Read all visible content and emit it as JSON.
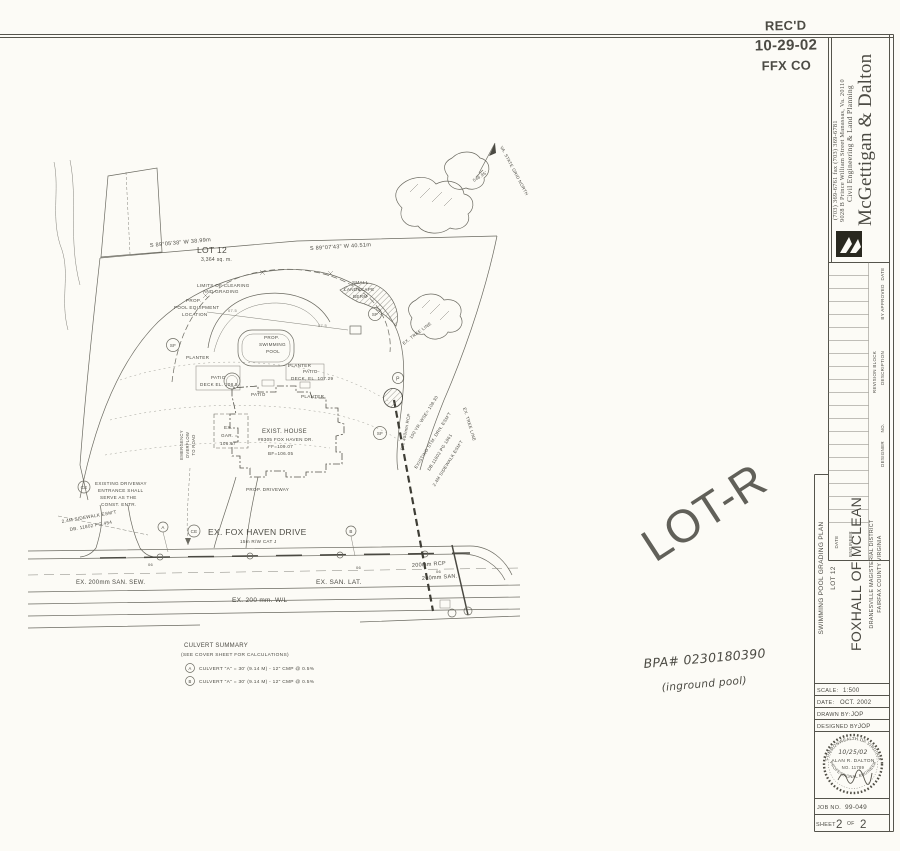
{
  "received_stamp": {
    "line1": "REC'D",
    "line2": "10-29-02",
    "line3": "FFX CO"
  },
  "firm": {
    "name": "McGettigan & Dalton",
    "tagline": "Civil Engineering & Land Planning",
    "address": "9028 B Prince William Street Manassas, Va. 20110",
    "phones": "(703) 369-6761        fax (703) 369-6781"
  },
  "revision_block": {
    "title": "REVISION BLOCK",
    "col_date": "DATE",
    "col_by": "BY APPROVED",
    "col_description": "DESCRIPTION",
    "col_no": "NO.",
    "col_designer": "DESIGNER",
    "col_engineer": "ENGINEER",
    "col_date2": "DATE"
  },
  "project": {
    "plan_type": "SWIMMING POOL GRADING PLAN",
    "lot": "LOT 12",
    "name": "FOXHALL OF MCLEAN",
    "district": "DRANESVILLE MAGISTERIAL DISTRICT",
    "county": "FAIRFAX COUNTY VIRGINIA"
  },
  "sheet_info": {
    "scale_label": "SCALE:",
    "scale": "1:500",
    "date_label": "DATE:",
    "date": "OCT. 2002",
    "drawn_label": "DRAWN BY:",
    "drawn": "JOP",
    "designed_label": "DESIGNED BY:",
    "designed": "JOP",
    "job_label": "JOB NO.",
    "job": "99-049",
    "sheet_label": "SHEET",
    "sheet": "2",
    "of": "OF",
    "total": "2"
  },
  "seal": {
    "arc_top": "COMMONWEALTH OF VIRGINIA",
    "date": "10/25/02",
    "name": "ALAN R. DALTON",
    "license": "NO. 11789",
    "arc_bottom": "PROFESSIONAL ENGINEER"
  },
  "annotations": {
    "red": "LOT-R",
    "permit": "BPA# 0230180390",
    "note": "(inground pool)"
  },
  "plan": {
    "north": "VA. STATE GRID NORTH",
    "bearing_left": "S 89°05'38\" W  38.99m",
    "bearing_right": "S 89°07'43\" W  40.51m",
    "dim": "546.95'",
    "lot": "LOT 12",
    "lot_area": "3,364 sq. m.",
    "limits1": "LIMITS OF CLEARING",
    "limits2": "AND GRADING",
    "equip1": "PROP.",
    "equip2": "POOL EQUIPMENT",
    "equip3": "LOCATION",
    "berm1": "SMALL",
    "berm2": "LANDSCAPE",
    "berm3": "BERM",
    "pool1": "PROP.",
    "pool2": "SWIMMING",
    "pool3": "POOL",
    "planter": "PLANTER",
    "patio": "PATIO",
    "patio_deck1": "PATIO",
    "patio_deck1b": "DECK EL. 108.5",
    "patio_deck2": "PATIO",
    "patio_deck2b": "DECK, EL. 107.29",
    "sf": "SF",
    "ce": "CE",
    "p": "P",
    "a": "A",
    "b": "B",
    "house1": "EXIST. HOUSE",
    "house2": "#8305 FOX HAVEN DR.",
    "house3": "FF=109.07",
    "house4": "BF=106.05",
    "gar1": "EX.",
    "gar2": "GAR. =",
    "gar3": "106.67",
    "overflow1": "EMERGENCY",
    "overflow2": "OVERFLOW",
    "overflow3": "TO ROAD",
    "prop_drive": "PROP. DRIVEWAY",
    "ce_note1": "EXISTING DRIVEWAY",
    "ce_note2": "ENTRANCE SHALL",
    "ce_note3": "SERVE AS THE",
    "ce_note4": "CONST. ENTR.",
    "sidewalk1": "2.4M SIDEWALK ESM'T",
    "sidewalk2": "DB. 11802 PG.454",
    "street": "EX. FOX HAVEN DRIVE",
    "street_sub": "15m  R/W   CAT J",
    "san_sew": "EX. 200mm SAN. SEW.",
    "san_lat": "EX. SAN. LAT.",
    "wl": "EX. 200 mm. W/L",
    "rcp": "200mm RCP",
    "san": "200mm SAN.",
    "storm1": "100 YR. WSE= 108.30",
    "storm2": "EXISTING STM. DRN. ESM'T",
    "storm3": "DB.11802 PG 1861",
    "storm4": "2.4M SIDEWALK ESM'T",
    "rcp450": "EX. 450mm RCP",
    "treeline": "EX. TREE LINE",
    "contour": "07.5",
    "ut": "06",
    "culvert_title": "CULVERT SUMMARY",
    "culvert_sub": "(SEE COVER SHEET FOR CALCULATIONS)",
    "culvert_a": "CULVERT \"A\"  =  30' (9.14 M)  -  12\" CMP @ 0.5%",
    "culvert_b": "CULVERT \"A\"  =  30' (9.14 M)  -  12\" CMP @ 0.5%"
  }
}
